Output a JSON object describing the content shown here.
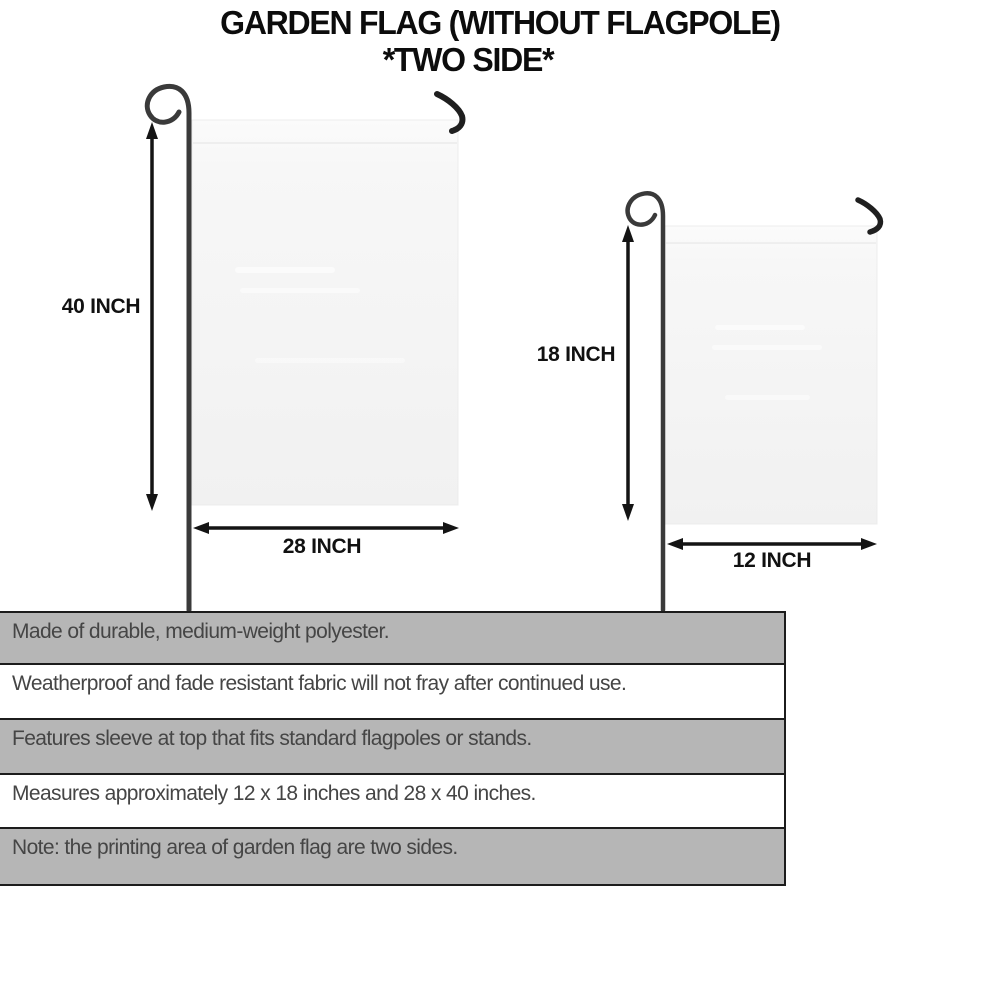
{
  "title": {
    "line1": "GARDEN FLAG (WITHOUT FLAGPOLE)",
    "line2": "*TWO SIDE*"
  },
  "diagrams": {
    "large_flag": {
      "height_label": "40 INCH",
      "width_label": "28 INCH"
    },
    "small_flag": {
      "height_label": "18 INCH",
      "width_label": "12 INCH"
    }
  },
  "features": [
    {
      "text": "Made of durable, medium-weight polyester."
    },
    {
      "text": "Weatherproof and fade resistant fabric will not fray after continued use."
    },
    {
      "text": "Features sleeve at top that fits standard flagpoles or stands."
    },
    {
      "text": "Measures approximately 12 x 18 inches and 28 x 40 inches."
    },
    {
      "text": "Note: the printing area of garden flag are two sides."
    }
  ],
  "colors": {
    "row_gray": "#b6b6b6",
    "row_border": "#1c1c1c",
    "row_text": "#454545",
    "flag_fill": "#f4f4f4",
    "pole": "#3a3a3a",
    "accent_black": "#111111"
  }
}
